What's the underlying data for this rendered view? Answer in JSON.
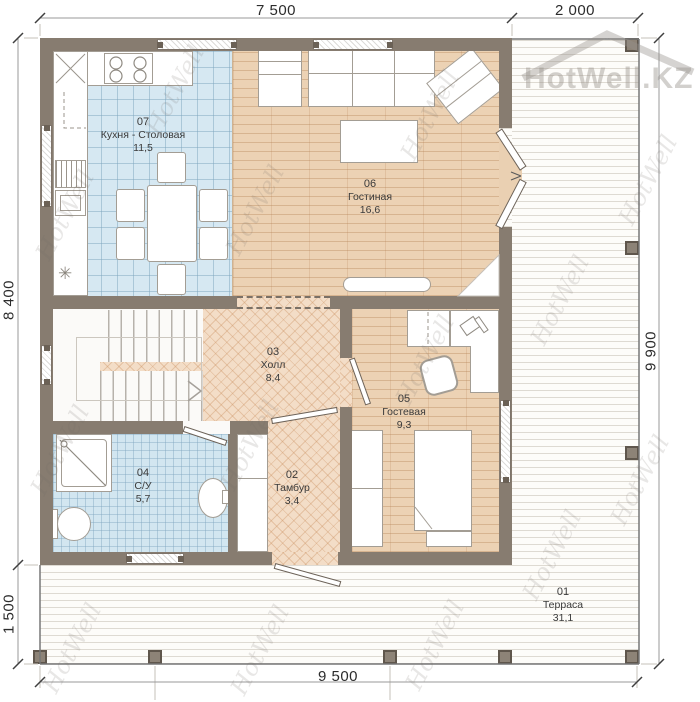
{
  "watermark": "HotWell",
  "logo": "HotWell.KZ",
  "dims": {
    "top_main": "7 500",
    "top_right": "2 000",
    "left_main": "8 400",
    "left_bottom": "1 500",
    "right_full": "9 900",
    "bottom_full": "9 500"
  },
  "rooms": [
    {
      "number": "01",
      "name": "Терраса",
      "area": "31,1"
    },
    {
      "number": "02",
      "name": "Тамбур",
      "area": "3,4"
    },
    {
      "number": "03",
      "name": "Холл",
      "area": "8,4"
    },
    {
      "number": "04",
      "name": "С/У",
      "area": "5,7"
    },
    {
      "number": "05",
      "name": "Гостевая",
      "area": "9,3"
    },
    {
      "number": "06",
      "name": "Гостиная",
      "area": "16,6"
    },
    {
      "number": "07",
      "name": "Кухня - Столовая",
      "area": "11,5"
    }
  ]
}
